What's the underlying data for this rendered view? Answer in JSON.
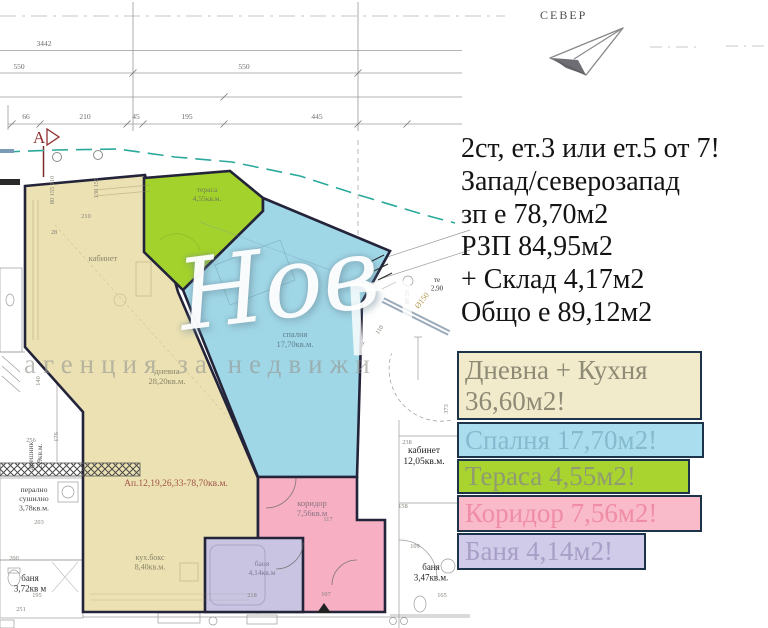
{
  "north": {
    "label": "СЕВЕР"
  },
  "listing": {
    "lines": [
      "2ст, ет.3 или ет.5 от 7!",
      "Запад/северозапад",
      "зп е 78,70м2",
      "РЗП 84,95м2",
      "+ Склад 4,17м2",
      "Общо е 89,12м2"
    ]
  },
  "legend": {
    "items": [
      {
        "line1": "Дневна + Кухня",
        "line2": "36,60м2!",
        "fill": "#f2ebcb",
        "text": "#8e8a76"
      },
      {
        "line1": "Спалня 17,70м2!",
        "fill": "#aadeee",
        "text": "#86bace"
      },
      {
        "line1": "Тераса 4,55м2!",
        "fill": "#a9d430",
        "text": "#8f9b70"
      },
      {
        "line1": "Коридор 7,56м2!",
        "fill": "#f9bac9",
        "text": "#f08da6"
      },
      {
        "line1": "Баня 4,14м2!",
        "fill": "#d0cbe8",
        "text": "#a89fc7"
      }
    ]
  },
  "colors": {
    "living": "#ebe1b2",
    "terrace": "#a4d22c",
    "bedroom": "#a0d7e7",
    "corridor": "#f6afc3",
    "bath": "#c9c4e2",
    "outline": "#23233a",
    "dash_teal": "#2ba99b",
    "marker_red": "#8f2f2f",
    "apt_note": "#a2564b"
  },
  "watermark": {
    "script": "Нов",
    "agency": "агенция за недвижи"
  },
  "top_dims": {
    "d3442": "3442",
    "d550a": "550",
    "d550b": "550",
    "row": [
      "66",
      "210",
      "45",
      "195",
      "445"
    ],
    "marker": "A"
  },
  "plan": {
    "labels": [
      {
        "ls": [
          "тераса",
          "4,55кв.м."
        ],
        "x": 207,
        "y": 192,
        "s": 7.5,
        "c": "#6e7a55"
      },
      {
        "ls": [
          "спалня",
          "17,70кв.м."
        ],
        "x": 295,
        "y": 337,
        "s": 8.5,
        "c": "#5f7f8c"
      },
      {
        "ls": [
          "кабинет"
        ],
        "x": 103,
        "y": 261,
        "s": 8.5,
        "c": "#8a8468"
      },
      {
        "ls": [
          "дневна",
          "28,20кв.м."
        ],
        "x": 167,
        "y": 374,
        "s": 8.5,
        "c": "#8a8468"
      },
      {
        "ls": [
          "Ап.12,19,26,33-78,70кв.м."
        ],
        "x": 176,
        "y": 486,
        "s": 9.5,
        "c": "#a2564b"
      },
      {
        "ls": [
          "кух.бокс",
          "8,40кв.м."
        ],
        "x": 150,
        "y": 560,
        "s": 8,
        "c": "#8a8468"
      },
      {
        "ls": [
          "коридор",
          "7,56кв.м"
        ],
        "x": 312,
        "y": 506,
        "s": 8.5,
        "c": "#8b7580"
      },
      {
        "ls": [
          "баня",
          "4,14кв.м"
        ],
        "x": 262,
        "y": 566,
        "s": 7.5,
        "c": "#7e7894"
      },
      {
        "ls": [
          "дрешник",
          "2,9кв.м."
        ],
        "x": 33,
        "y": 456,
        "s": 7.5,
        "c": "#555555",
        "r": -90
      },
      {
        "ls": [
          "перално",
          "сушилно",
          "3,78кв.м."
        ],
        "x": 34,
        "y": 492,
        "s": 7.8,
        "c": "#3f3f3f"
      },
      {
        "ls": [
          "баня",
          "3,72кв м"
        ],
        "x": 30,
        "y": 581,
        "s": 9,
        "c": "#2f2f2f"
      },
      {
        "ls": [
          "кабинет",
          "12,05кв.м."
        ],
        "x": 424,
        "y": 453,
        "s": 9.5,
        "c": "#1f1f1f"
      },
      {
        "ls": [
          "баня",
          "3,47кв.м."
        ],
        "x": 431,
        "y": 570,
        "s": 9,
        "c": "#1f1f1f"
      },
      {
        "ls": [
          "те",
          "2,90"
        ],
        "x": 437,
        "y": 282,
        "s": 7,
        "c": "#333333"
      },
      {
        "ls": [
          "Ø150"
        ],
        "x": 424,
        "y": 302,
        "s": 8,
        "c": "#b3954a",
        "r": -52
      }
    ],
    "dims": [
      {
        "t": "28",
        "x": 54,
        "y": 234
      },
      {
        "t": "210",
        "x": 86,
        "y": 218
      },
      {
        "t": "140",
        "x": 40,
        "y": 381,
        "r": -90
      },
      {
        "t": "176",
        "x": 58,
        "y": 437,
        "r": -90
      },
      {
        "t": "256",
        "x": 31,
        "y": 442
      },
      {
        "t": "203",
        "x": 39,
        "y": 524
      },
      {
        "t": "200",
        "x": 14,
        "y": 560
      },
      {
        "t": "195",
        "x": 37,
        "y": 597
      },
      {
        "t": "251",
        "x": 21,
        "y": 611
      },
      {
        "t": "238",
        "x": 407,
        "y": 444
      },
      {
        "t": "158",
        "x": 403,
        "y": 508
      },
      {
        "t": "109",
        "x": 415,
        "y": 548
      },
      {
        "t": "165",
        "x": 442,
        "y": 597
      },
      {
        "t": "373",
        "x": 448,
        "y": 409,
        "r": -90
      },
      {
        "t": "110",
        "x": 381,
        "y": 331,
        "r": -55
      },
      {
        "t": "152",
        "x": 363,
        "y": 346,
        "r": -70
      },
      {
        "t": "218",
        "x": 252,
        "y": 597
      },
      {
        "t": "107",
        "x": 326,
        "y": 596
      },
      {
        "t": "117",
        "x": 328,
        "y": 521
      },
      {
        "t": "80 50",
        "x": 409,
        "y": 297,
        "r": -90
      },
      {
        "t": "80 155 210",
        "x": 54,
        "y": 190,
        "r": -90
      },
      {
        "t": "130 155",
        "x": 98,
        "y": 188,
        "r": -90
      }
    ]
  }
}
